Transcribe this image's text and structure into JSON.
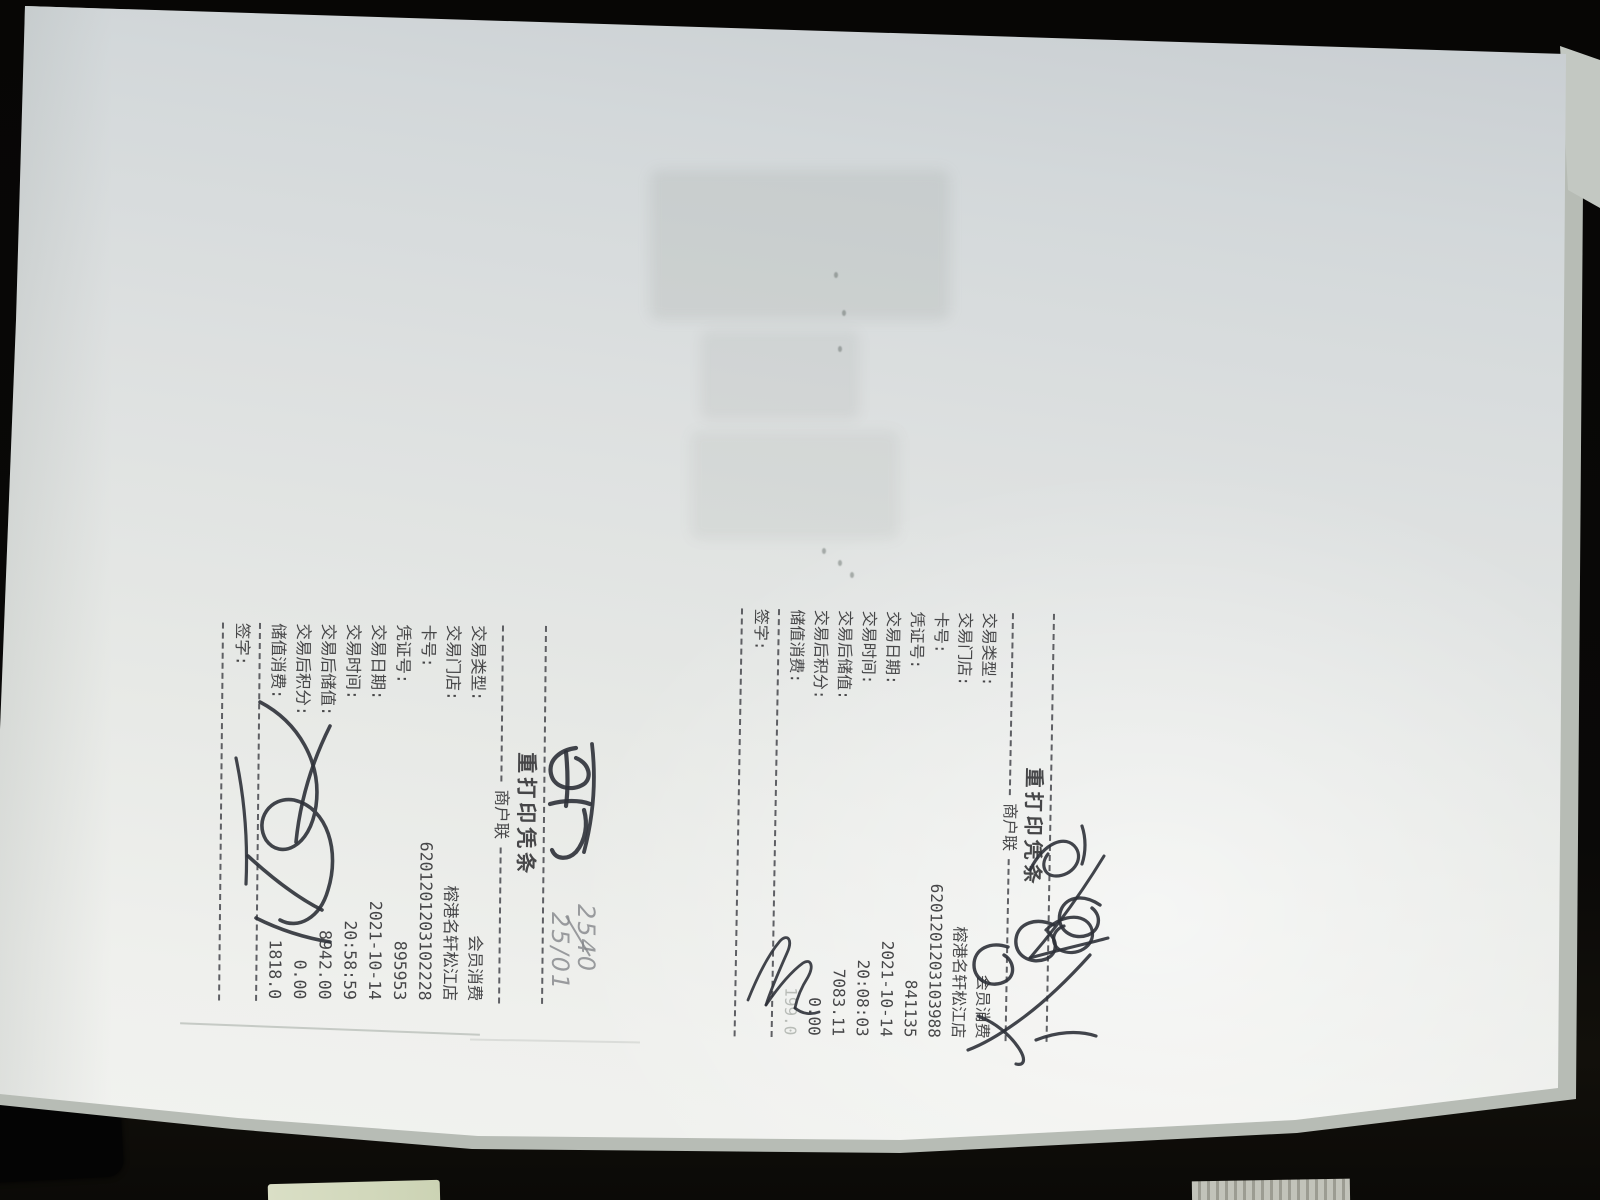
{
  "receipts": [
    {
      "id": "receipt-right",
      "title": "重打印凭条",
      "copy_label": "商户联",
      "fields": [
        {
          "label": "交易类型:",
          "value": "会员消费"
        },
        {
          "label": "交易门店:",
          "value": "榕港名轩松江店"
        },
        {
          "label": "卡号:",
          "value": "6201201203103988"
        },
        {
          "label": "凭证号:",
          "value": "841135"
        },
        {
          "label": "交易日期:",
          "value": "2021-10-14"
        },
        {
          "label": "交易时间:",
          "value": "20:08:03"
        },
        {
          "label": "交易后储值:",
          "value": "7083.11"
        },
        {
          "label": "交易后积分:",
          "value": "0.00"
        },
        {
          "label": "储值消费:",
          "value": "199.0"
        }
      ],
      "sign_label": "签字:"
    },
    {
      "id": "receipt-left",
      "title": "重打印凭条",
      "copy_label": "商户联",
      "fields": [
        {
          "label": "交易类型:",
          "value": "会员消费"
        },
        {
          "label": "交易门店:",
          "value": "榕港名轩松江店"
        },
        {
          "label": "卡号:",
          "value": "6201201203102228"
        },
        {
          "label": "凭证号:",
          "value": "895953"
        },
        {
          "label": "交易日期:",
          "value": "2021-10-14"
        },
        {
          "label": "交易时间:",
          "value": "20:58:59"
        },
        {
          "label": "交易后储值:",
          "value": "8942.00"
        },
        {
          "label": "交易后积分:",
          "value": "0.00"
        },
        {
          "label": "储值消费:",
          "value": "1818.0"
        }
      ],
      "sign_label": "签字:"
    }
  ],
  "annotations": {
    "pencil_crossed_out": "2540",
    "pencil_note": "25/01",
    "ink_note_right": "illegible ink note",
    "ink_figures_right": "illegible scrawled figures",
    "signature_right": "handwritten signature",
    "ink_note_left": "illegible ink note",
    "signature_left": "handwritten signature"
  },
  "colors": {
    "background": "#0a0908",
    "paper": "#e7e9e6",
    "print_ink": "#3a3a3c",
    "pen_ink": "#2e3138",
    "pencil": "#84868a",
    "green_object": "#d6dcc0"
  }
}
